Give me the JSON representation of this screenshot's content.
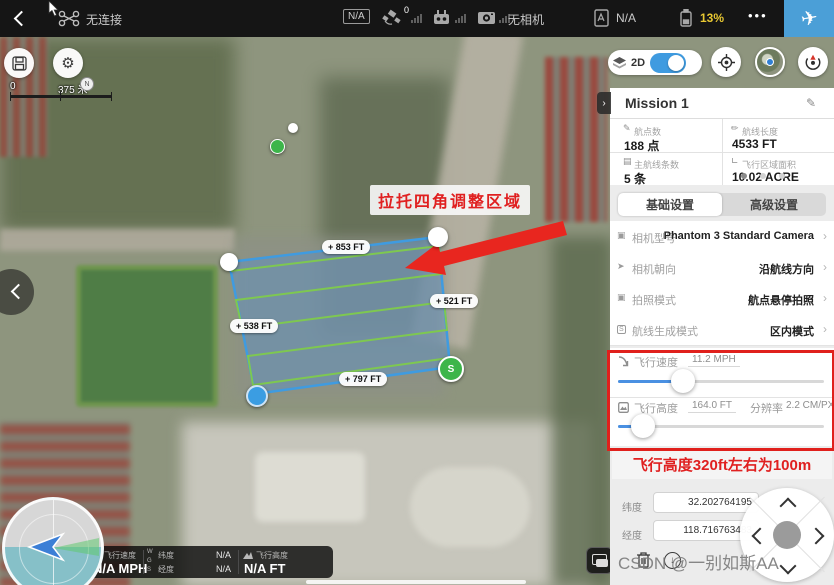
{
  "topbar": {
    "connection_status": "无连接",
    "gps_mode": "N/A",
    "satellite_count": "0",
    "camera_status": "无相机",
    "flight_mode": "N/A",
    "battery_level": "13%",
    "more_label": "•••"
  },
  "map_controls": {
    "view_toggle_label": "2D",
    "scale_zero": "0",
    "scale_distance": "375 米"
  },
  "map_overlay": {
    "annotation_text": "拉托四角调整区域",
    "distance_labels": [
      "+ 853 FT",
      "+ 521 FT",
      "+ 538 FT",
      "+ 797 FT"
    ],
    "start_marker": "S",
    "compass_north": "N"
  },
  "mission_panel": {
    "title": "Mission 1",
    "stats": [
      {
        "label": "航点数",
        "value": "188 点"
      },
      {
        "label": "航线长度",
        "value": "4533 FT"
      },
      {
        "label": "主航线条数",
        "value": "5 条"
      },
      {
        "label": "飞行区域面积",
        "value": "10.02 ACRE"
      }
    ],
    "tabs": [
      {
        "label": "基础设置"
      },
      {
        "label": "高级设置"
      }
    ],
    "settings": [
      {
        "label": "相机型号",
        "value": "Phantom 3 Standard Camera"
      },
      {
        "label": "相机朝向",
        "value": "沿航线方向"
      },
      {
        "label": "拍照模式",
        "value": "航点悬停拍照"
      },
      {
        "label": "航线生成模式",
        "value": "区内模式"
      }
    ],
    "speed_label": "飞行速度",
    "speed_value": "11.2 MPH",
    "altitude_label": "飞行高度",
    "altitude_value": "164.0 FT",
    "resolution_label": "分辨率",
    "resolution_value": "2.2 CM/PX",
    "note": "飞行高度320ft左右为100m",
    "lat_label": "纬度",
    "lat_value": "32.202764195",
    "lng_label": "经度",
    "lng_value": "118.716763483"
  },
  "statusbar": {
    "speed_label": "飞行速度",
    "speed_value": "N/A MPH",
    "datum_letters": [
      "W",
      "G",
      "S"
    ],
    "lat_label": "纬度",
    "lat_value": "N/A",
    "lng_label": "经度",
    "lng_value": "N/A",
    "altitude_label": "飞行高度",
    "altitude_value": "N/A FT"
  },
  "watermark": "CSDN @一别如斯AA",
  "colors": {
    "accent_blue": "#4b9fd7",
    "slider_blue": "#4a90e2",
    "warning_red": "#e0201c",
    "battery_yellow": "#e8c832",
    "route_green": "#7ec850",
    "polygon_blue": "#3f9be0"
  }
}
